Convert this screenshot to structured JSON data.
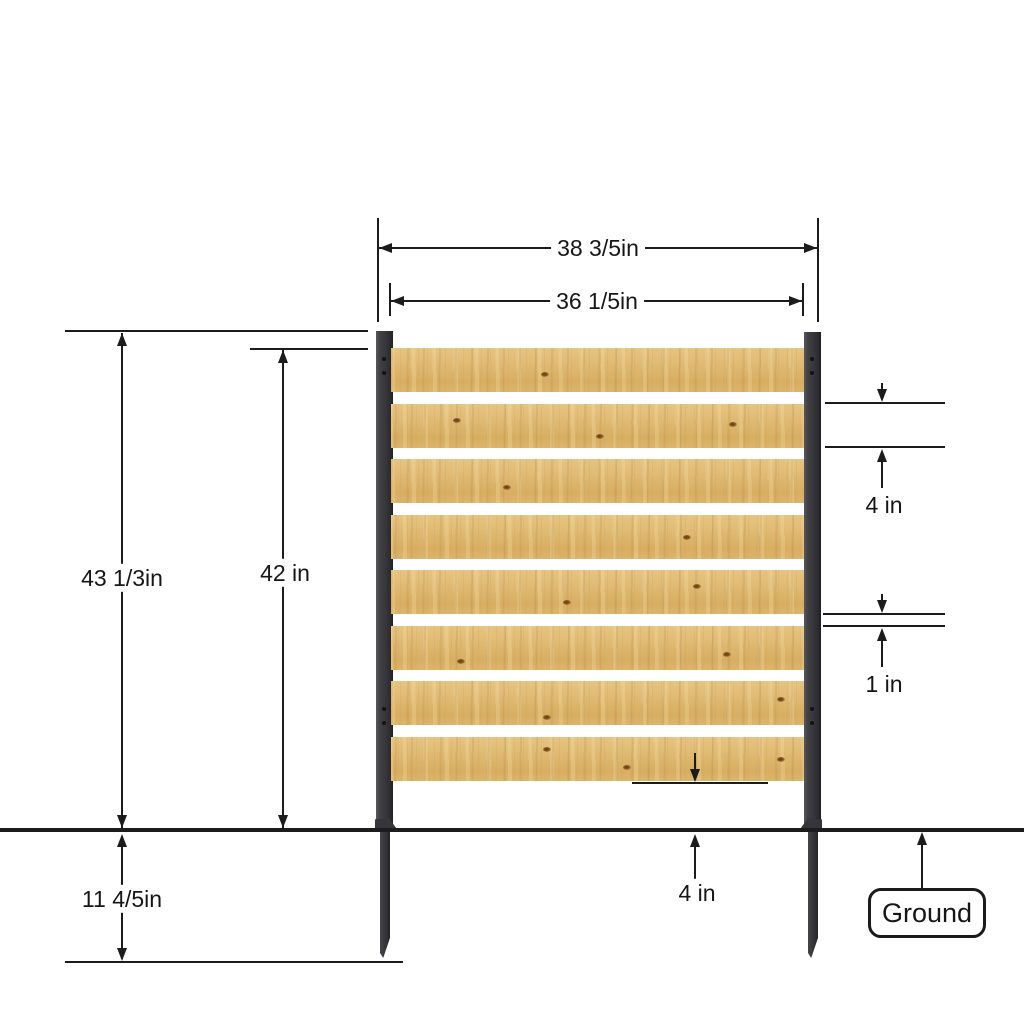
{
  "diagram": {
    "type": "fence-panel-dimension-drawing",
    "labels": {
      "outer_width": "38 3/5in",
      "inner_width": "36 1/5in",
      "overall_height": "43 1/3in",
      "panel_height": "42 in",
      "slat_height": "4 in",
      "slat_gap": "1 in",
      "bottom_clearance": "4 in",
      "underground_depth": "11 4/5in",
      "ground_label": "Ground"
    },
    "structure": {
      "slat_count": 8,
      "post_count": 2
    },
    "colors": {
      "line": "#1c1c1c",
      "wood_light": "#e6c482",
      "wood_dark": "#d7ae62",
      "post": "#38383c",
      "background": "#ffffff"
    }
  }
}
